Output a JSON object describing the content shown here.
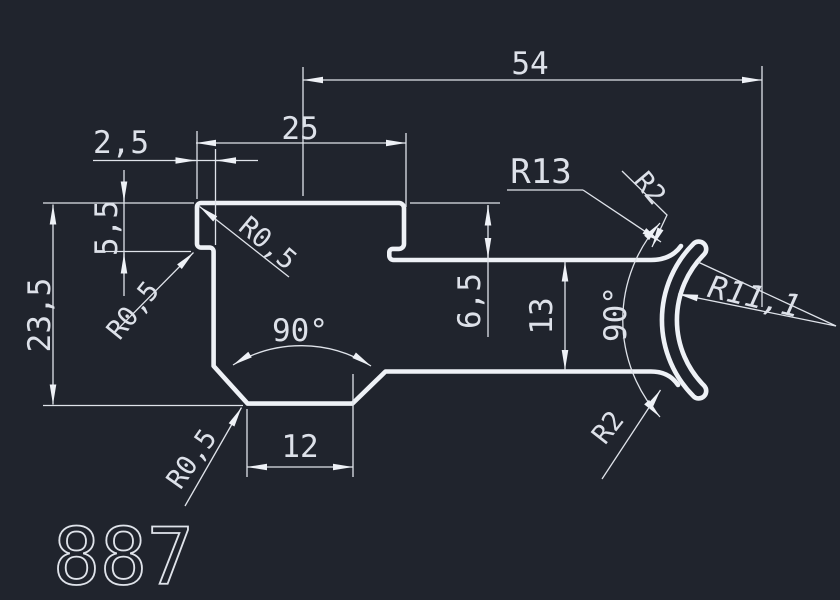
{
  "drawing": {
    "part_number": "887",
    "background_color": "#20242d",
    "line_color": "#eef1f6",
    "text_color": "#dde1e9",
    "dim_labels": {
      "overall_width": "54",
      "top_plate_width": "25",
      "step_width": "2,5",
      "step_height": "5,5",
      "overall_height": "23,5",
      "upper_arm_offset": "6,5",
      "arm_spacing": "13",
      "bottom_flat_width": "12",
      "bottom_angle": "90°",
      "right_angle": "90°"
    },
    "radius_labels": {
      "outer_arc": "R13",
      "inner_arc": "R11,1",
      "tip_top": "R2",
      "tip_bottom": "R2",
      "fillet_top_left": "R0,5",
      "fillet_step": "R0,5",
      "fillet_bottom": "R0,5"
    }
  }
}
